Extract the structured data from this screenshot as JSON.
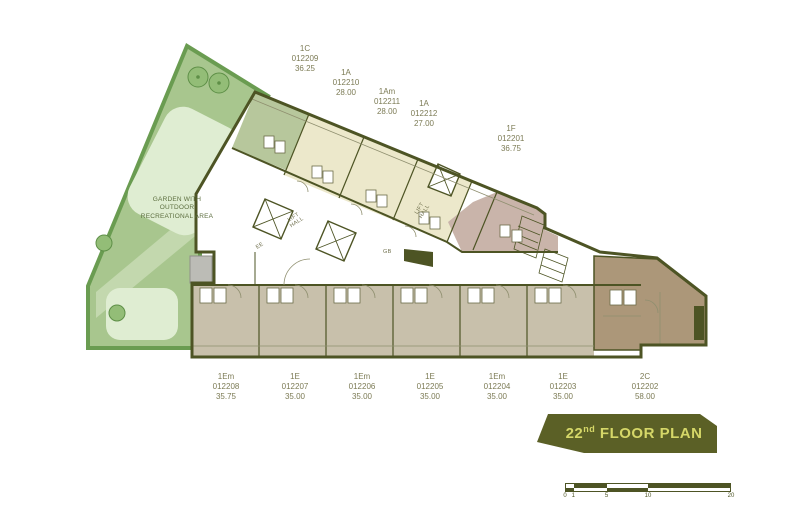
{
  "banner": {
    "floor": "22",
    "ordinal": "nd",
    "text": "FLOOR PLAN"
  },
  "garden": {
    "label_lines": [
      "GARDEN WITH",
      "OUTDOOR",
      "RECREATIONAL AREA"
    ]
  },
  "units_top": [
    {
      "type": "1C",
      "number": "012209",
      "area": "36.25"
    },
    {
      "type": "1A",
      "number": "012210",
      "area": "28.00"
    },
    {
      "type": "1Am",
      "number": "012211",
      "area": "28.00"
    },
    {
      "type": "1A",
      "number": "012212",
      "area": "27.00"
    },
    {
      "type": "1F",
      "number": "012201",
      "area": "36.75"
    }
  ],
  "units_bottom": [
    {
      "type": "1Em",
      "number": "012208",
      "area": "35.75"
    },
    {
      "type": "1E",
      "number": "012207",
      "area": "35.00"
    },
    {
      "type": "1Em",
      "number": "012206",
      "area": "35.00"
    },
    {
      "type": "1E",
      "number": "012205",
      "area": "35.00"
    },
    {
      "type": "1Em",
      "number": "012204",
      "area": "35.00"
    },
    {
      "type": "1E",
      "number": "012203",
      "area": "35.00"
    },
    {
      "type": "2C",
      "number": "012202",
      "area": "58.00"
    }
  ],
  "core": {
    "lift_hall_line1": "LIFT",
    "lift_hall_line2": "HALL",
    "ee": "EE",
    "gb": "GB"
  },
  "scale_bar": {
    "labels": [
      "0",
      "1",
      "5",
      "10",
      "20"
    ]
  },
  "colors": {
    "wall": "#4d5424",
    "unit_cream": "#ece8cb",
    "unit_green": "#b7c79c",
    "unit_mauve": "#c9b4aa",
    "unit_taupe": "#c8c0ab",
    "unit_brown": "#ac9779",
    "garden_green": "#a8c68e",
    "hedge_green": "#6a9c51",
    "lawn_pale": "#dfedd2",
    "banner_bg": "#5b6026",
    "banner_text": "#d5d768"
  }
}
